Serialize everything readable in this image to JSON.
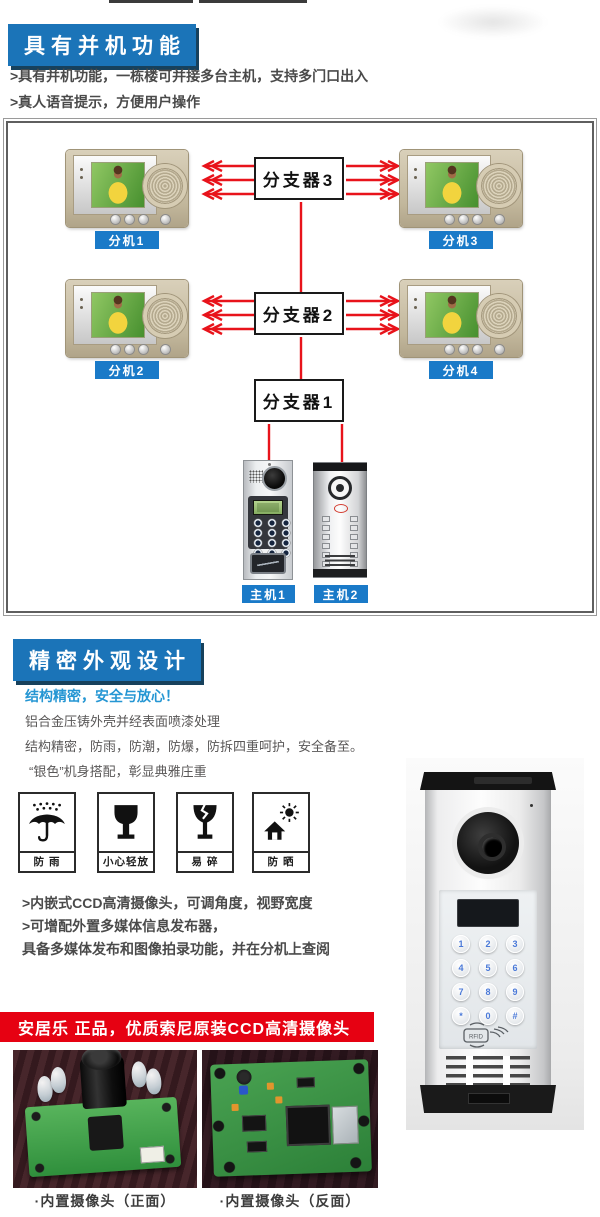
{
  "colors": {
    "banner_blue": "#1b74b8",
    "banner_shadow": "#17415c",
    "badge_blue": "#1a7ac8",
    "subtitle_blue": "#2596d3",
    "arrow_red": "#e8131b",
    "banner_red": "#e60112",
    "text_dark": "#4a4a4a",
    "text_gray": "#595757"
  },
  "section_parallel": {
    "banner": "具有并机功能",
    "bullets": [
      ">具有并机功能，一栋楼可并接多台主机，支持多门口出入",
      ">真人语音提示，方便用户操作"
    ],
    "diagram": {
      "monitors": [
        {
          "label": "分机1"
        },
        {
          "label": "分机3"
        },
        {
          "label": "分机2"
        },
        {
          "label": "分机4"
        }
      ],
      "splitters": [
        {
          "label": "分支器3"
        },
        {
          "label": "分支器2"
        },
        {
          "label": "分支器1"
        }
      ],
      "door_stations": [
        {
          "label": "主机1"
        },
        {
          "label": "主机2"
        }
      ]
    }
  },
  "section_design": {
    "banner": "精密外观设计",
    "subtitle": "结构精密，安全与放心！",
    "paragraphs": [
      "铝合金压铸外壳并经表面喷漆处理",
      "结构精密，防雨，防潮，防爆，防拆四重呵护，安全备至。",
      "“银色”机身搭配，彰显典雅庄重"
    ],
    "care_icons": [
      {
        "label": "防 雨"
      },
      {
        "label": "小心轻放"
      },
      {
        "label": "易 碎"
      },
      {
        "label": "防 晒"
      }
    ],
    "bullets": [
      ">内嵌式CCD高清摄像头，可调角度，视野宽度",
      ">可增配外置多媒体信息发布器，",
      "具备多媒体发布和图像拍录功能，并在分机上查阅"
    ],
    "door_station": {
      "keys": [
        "1",
        "2",
        "3",
        "4",
        "5",
        "6",
        "7",
        "8",
        "9",
        "*",
        "0",
        "#"
      ],
      "rfid_label": "RFID"
    }
  },
  "section_camera": {
    "banner": "安居乐 正品，优质索尼原装CCD高清摄像头",
    "captions": [
      "·内置摄像头（正面）",
      "·内置摄像头（反面）"
    ]
  }
}
